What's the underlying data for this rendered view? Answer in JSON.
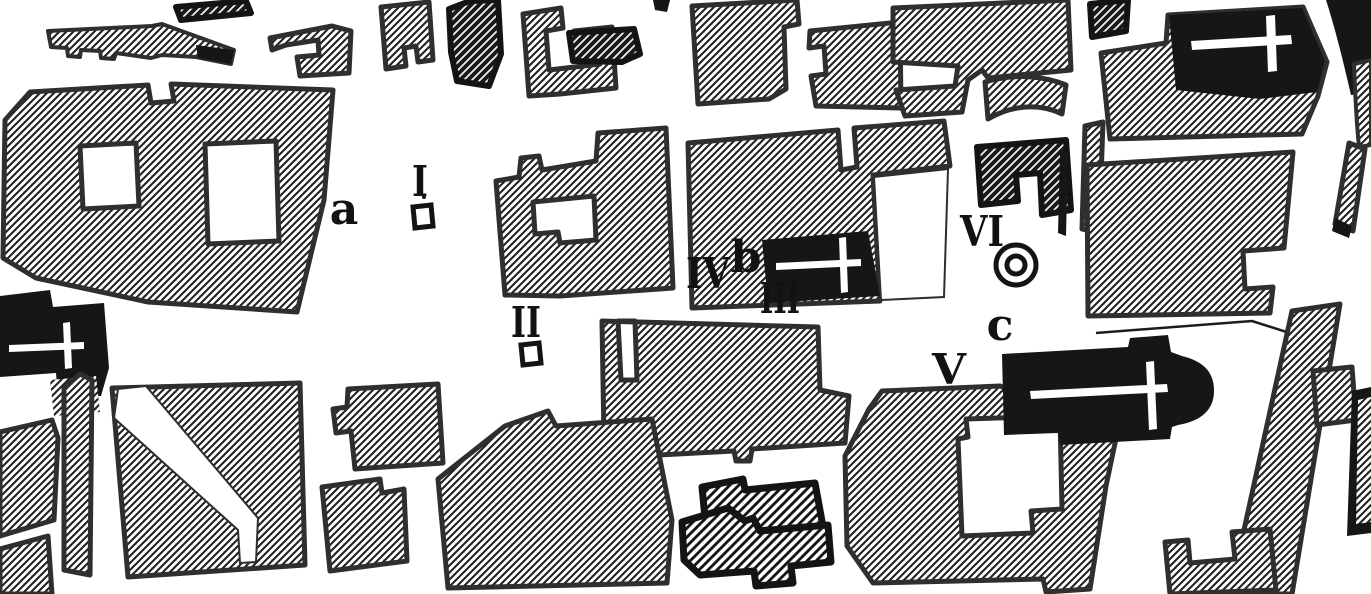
{
  "meta": {
    "title": "Scanned historic town plan with numbered excavation sites",
    "map_type": "black-and-white archaeological city-block plan"
  },
  "colors": {
    "paper": "#ffffff",
    "ink": "#161616",
    "block_border": "#2f2f2f",
    "hatch_line": "#222222"
  },
  "labels": [
    {
      "id": "numeral-I",
      "text": "I"
    },
    {
      "id": "letter-a",
      "text": "a"
    },
    {
      "id": "numeral-II",
      "text": "II"
    },
    {
      "id": "numeral-IV",
      "text": "IV"
    },
    {
      "id": "letter-b",
      "text": "b"
    },
    {
      "id": "numeral-III",
      "text": "III"
    },
    {
      "id": "numeral-VI",
      "text": "VI"
    },
    {
      "id": "letter-c",
      "text": "c"
    },
    {
      "id": "numeral-V",
      "text": "V"
    }
  ],
  "symbols": [
    {
      "name": "site-square-marker-I",
      "meaning": "small open square beside numeral I"
    },
    {
      "name": "site-square-marker-II",
      "meaning": "small open square beside numeral II"
    },
    {
      "name": "double-circle-monument",
      "meaning": "double ring symbol beside numeral VI"
    },
    {
      "name": "church-cross-top-right",
      "meaning": "white cross on solid black church"
    },
    {
      "name": "church-cross-left",
      "meaning": "white cross on solid black church"
    },
    {
      "name": "church-cross-b",
      "meaning": "white cross on solid black church at site b"
    },
    {
      "name": "church-cross-v",
      "meaning": "white cross on solid black church with apse at site V"
    }
  ]
}
